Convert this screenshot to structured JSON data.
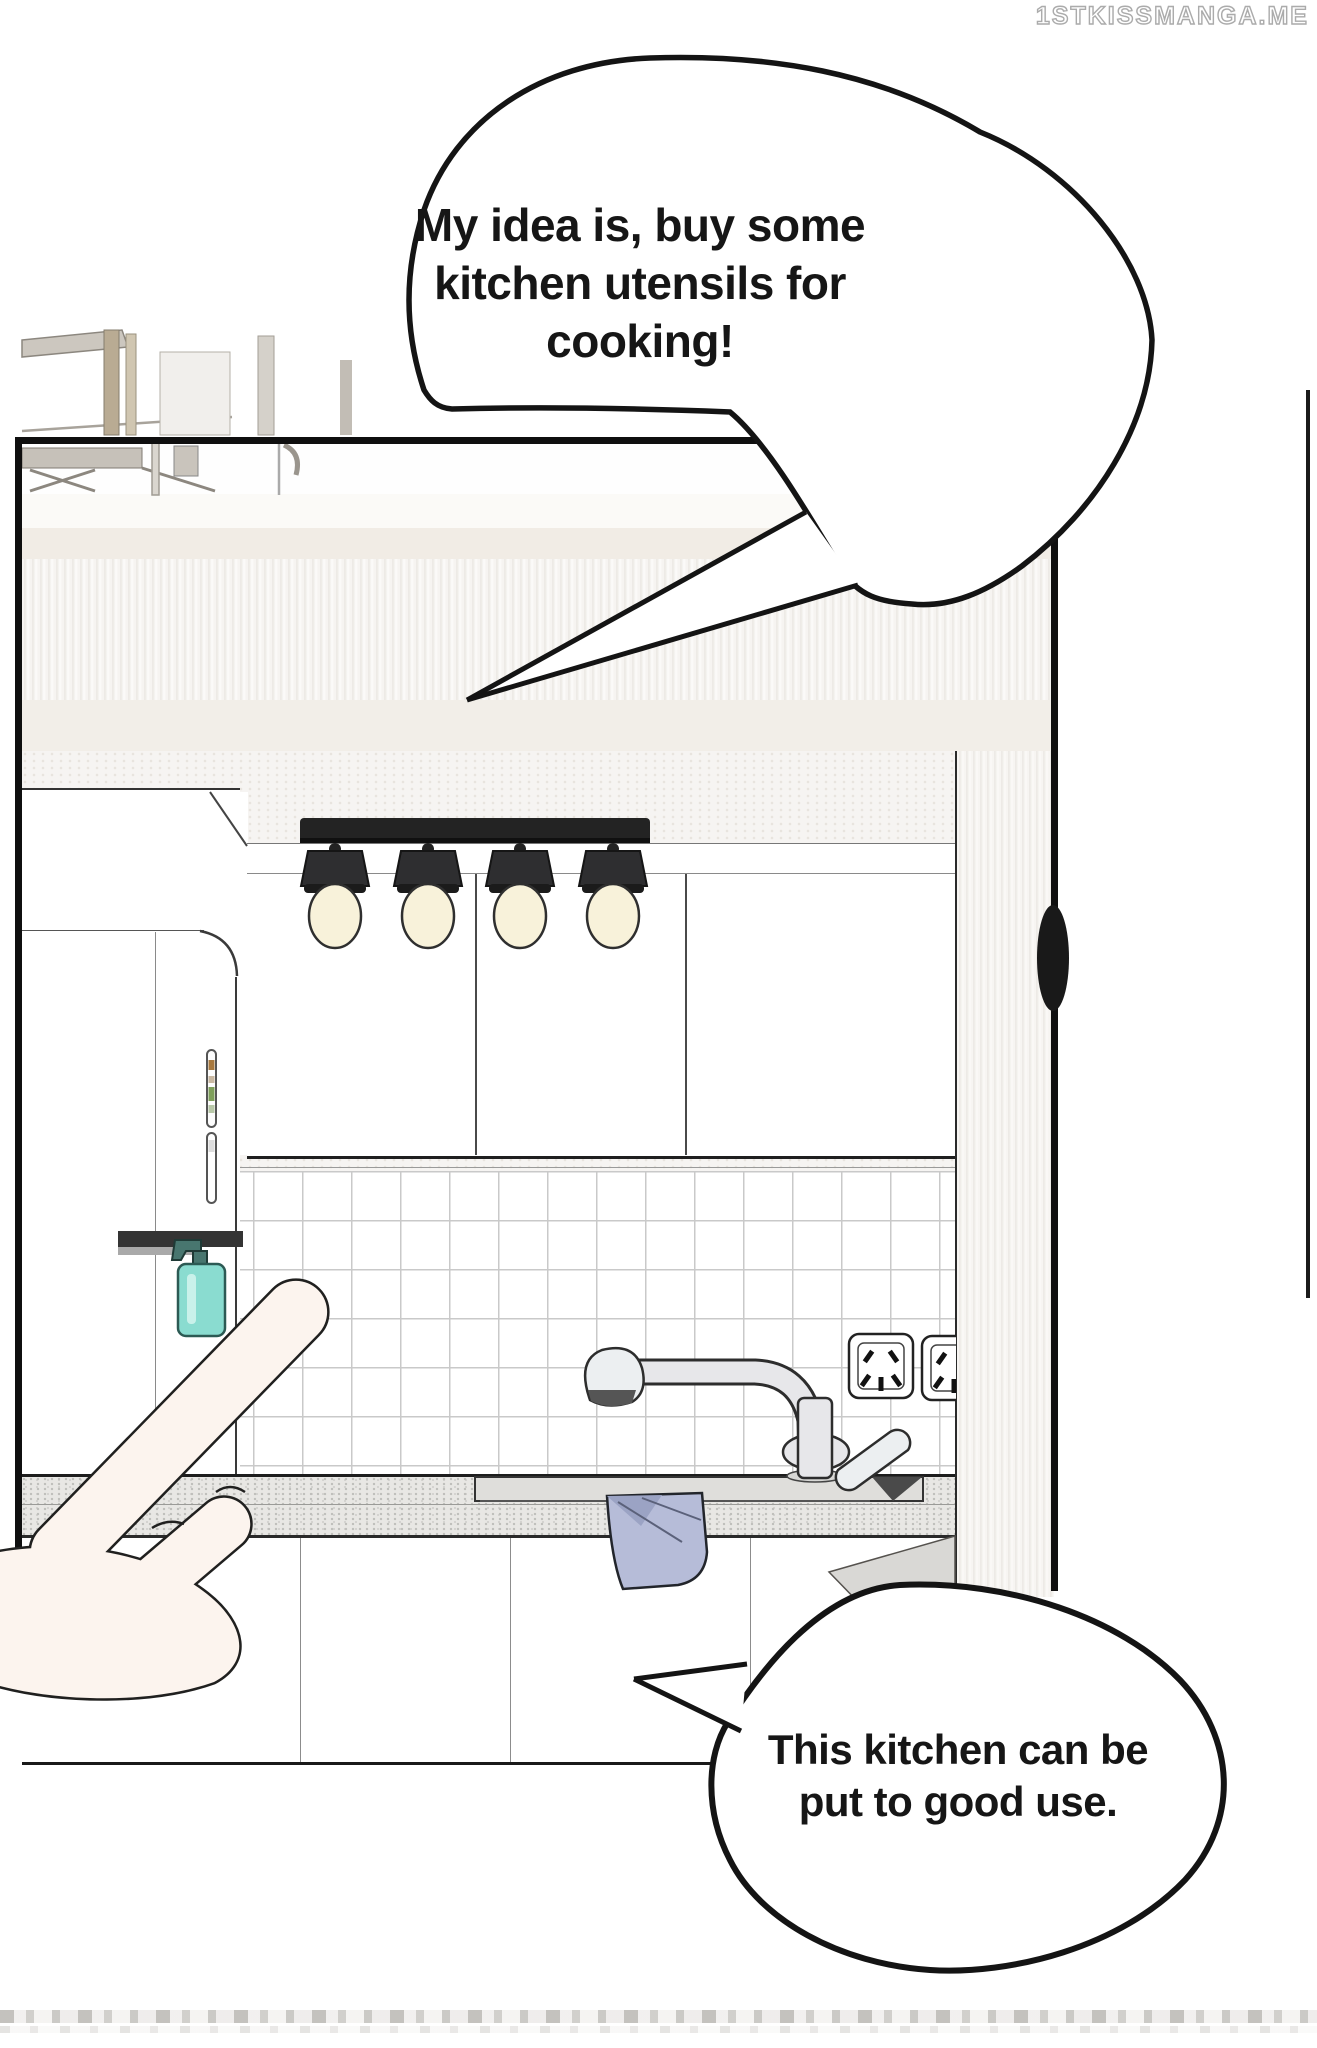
{
  "watermark": {
    "text": "1STKISSMANGA.ME"
  },
  "bubbles": {
    "top": {
      "lines": [
        "My idea is, buy some",
        "kitchen utensils for",
        "cooking!"
      ]
    },
    "bottom": {
      "lines": [
        "This kitchen can be",
        "put to good use."
      ]
    }
  },
  "colors": {
    "outline": "#1d1d1d",
    "towel": "#b6bcd8",
    "soap-bottle": "#8adcd0",
    "soap-pump": "#48766f",
    "bulb": "#f8f2da",
    "lamp": "#2e2e30",
    "skin": "#fcf4ee",
    "cream-band": "#f1ece5",
    "counter": "#e8e7e4",
    "tile-grout": "#c9c9c9"
  }
}
